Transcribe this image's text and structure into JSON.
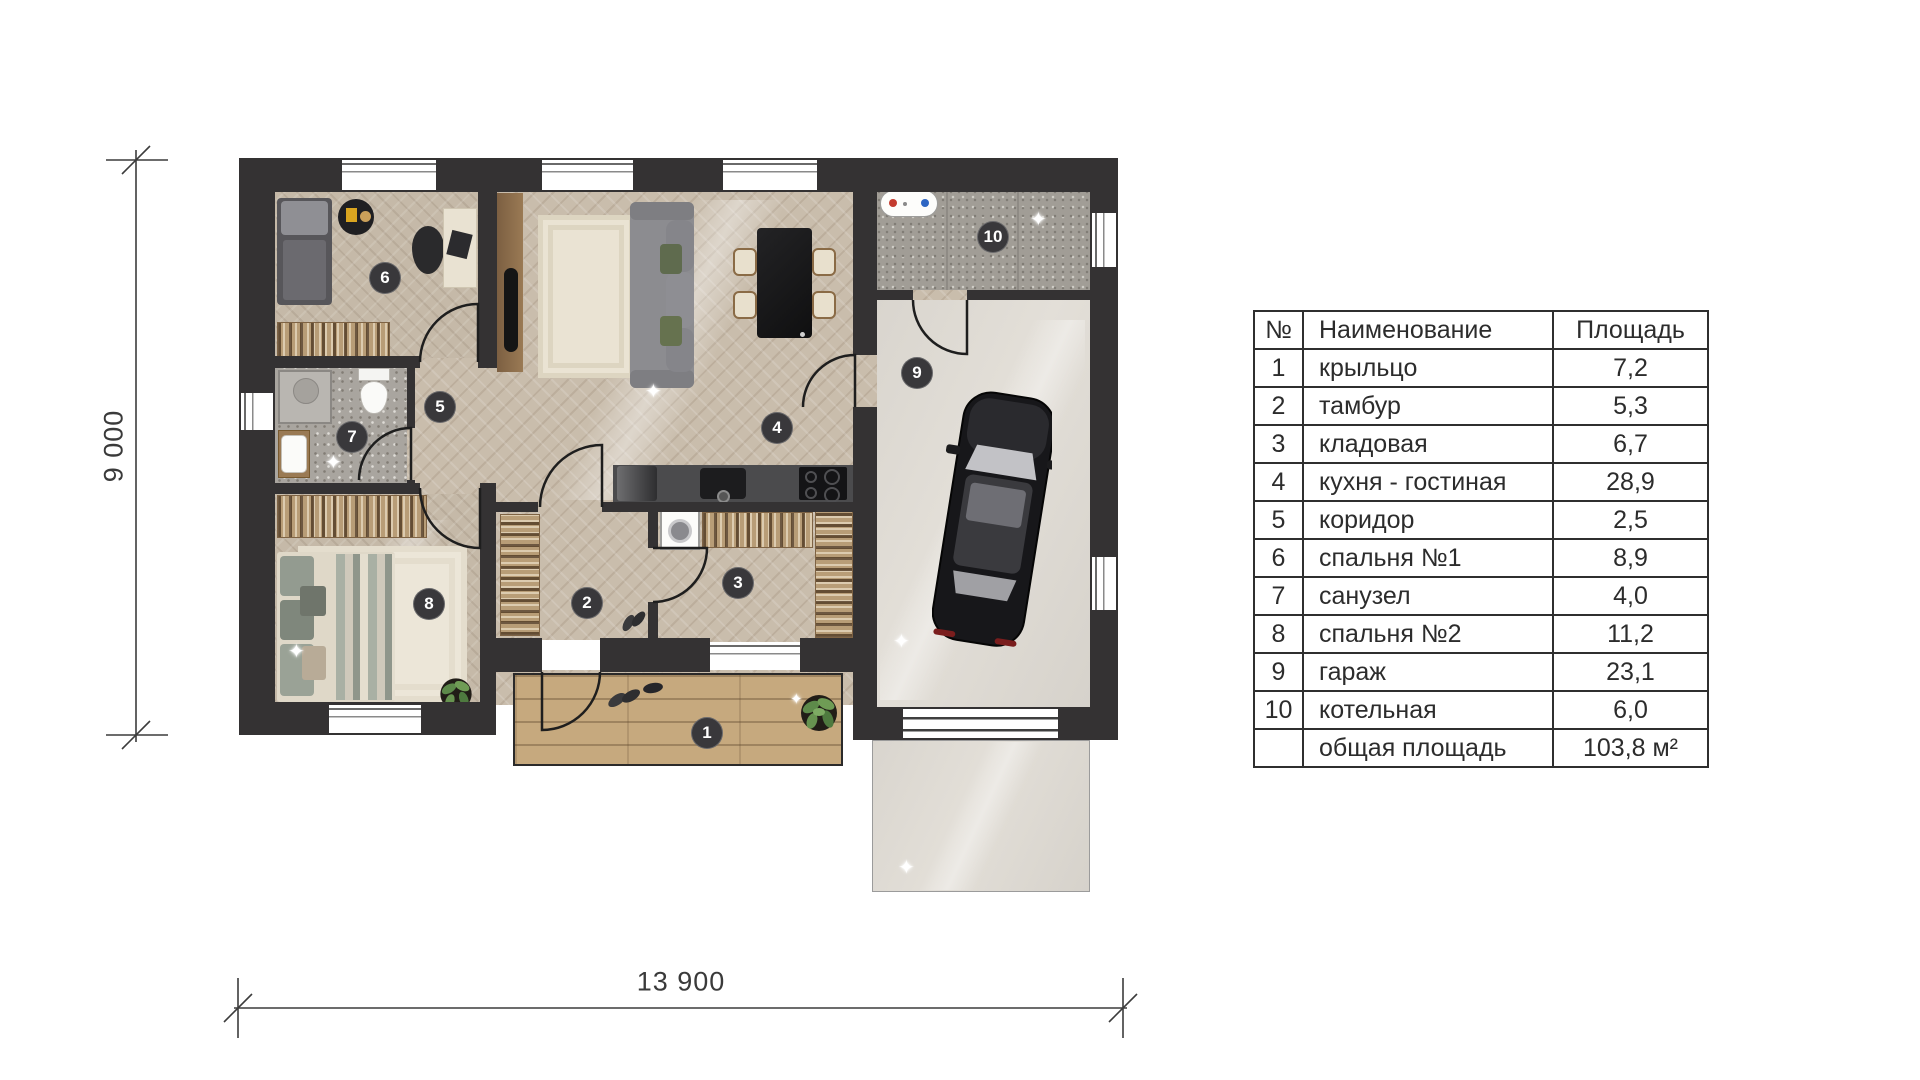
{
  "plan": {
    "dimension_height_label": "9 000",
    "dimension_width_label": "13 900",
    "room_labels": [
      "1",
      "2",
      "3",
      "4",
      "5",
      "6",
      "7",
      "8",
      "9",
      "10"
    ]
  },
  "table": {
    "headers": {
      "num": "№",
      "name": "Наименование",
      "area": "Площадь"
    },
    "rows": [
      {
        "num": "1",
        "name": "крыльцо",
        "area": "7,2"
      },
      {
        "num": "2",
        "name": "тамбур",
        "area": "5,3"
      },
      {
        "num": "3",
        "name": "кладовая",
        "area": "6,7"
      },
      {
        "num": "4",
        "name": "кухня - гостиная",
        "area": "28,9"
      },
      {
        "num": "5",
        "name": "коридор",
        "area": "2,5"
      },
      {
        "num": "6",
        "name": "спальня №1",
        "area": "8,9"
      },
      {
        "num": "7",
        "name": "санузел",
        "area": "4,0"
      },
      {
        "num": "8",
        "name": "спальня №2",
        "area": "11,2"
      },
      {
        "num": "9",
        "name": "гараж",
        "area": "23,1"
      },
      {
        "num": "10",
        "name": "котельная",
        "area": "6,0"
      },
      {
        "num": "",
        "name": "общая площадь",
        "area": "103,8 м²"
      }
    ]
  },
  "colors": {
    "wall": "#343233",
    "parquet": "#c9bdac",
    "garage_floor": "#d9d5ce",
    "porch_wood": "#c6a97e",
    "label_badge": "#39383b",
    "dimension_text": "#3a3a3a"
  }
}
